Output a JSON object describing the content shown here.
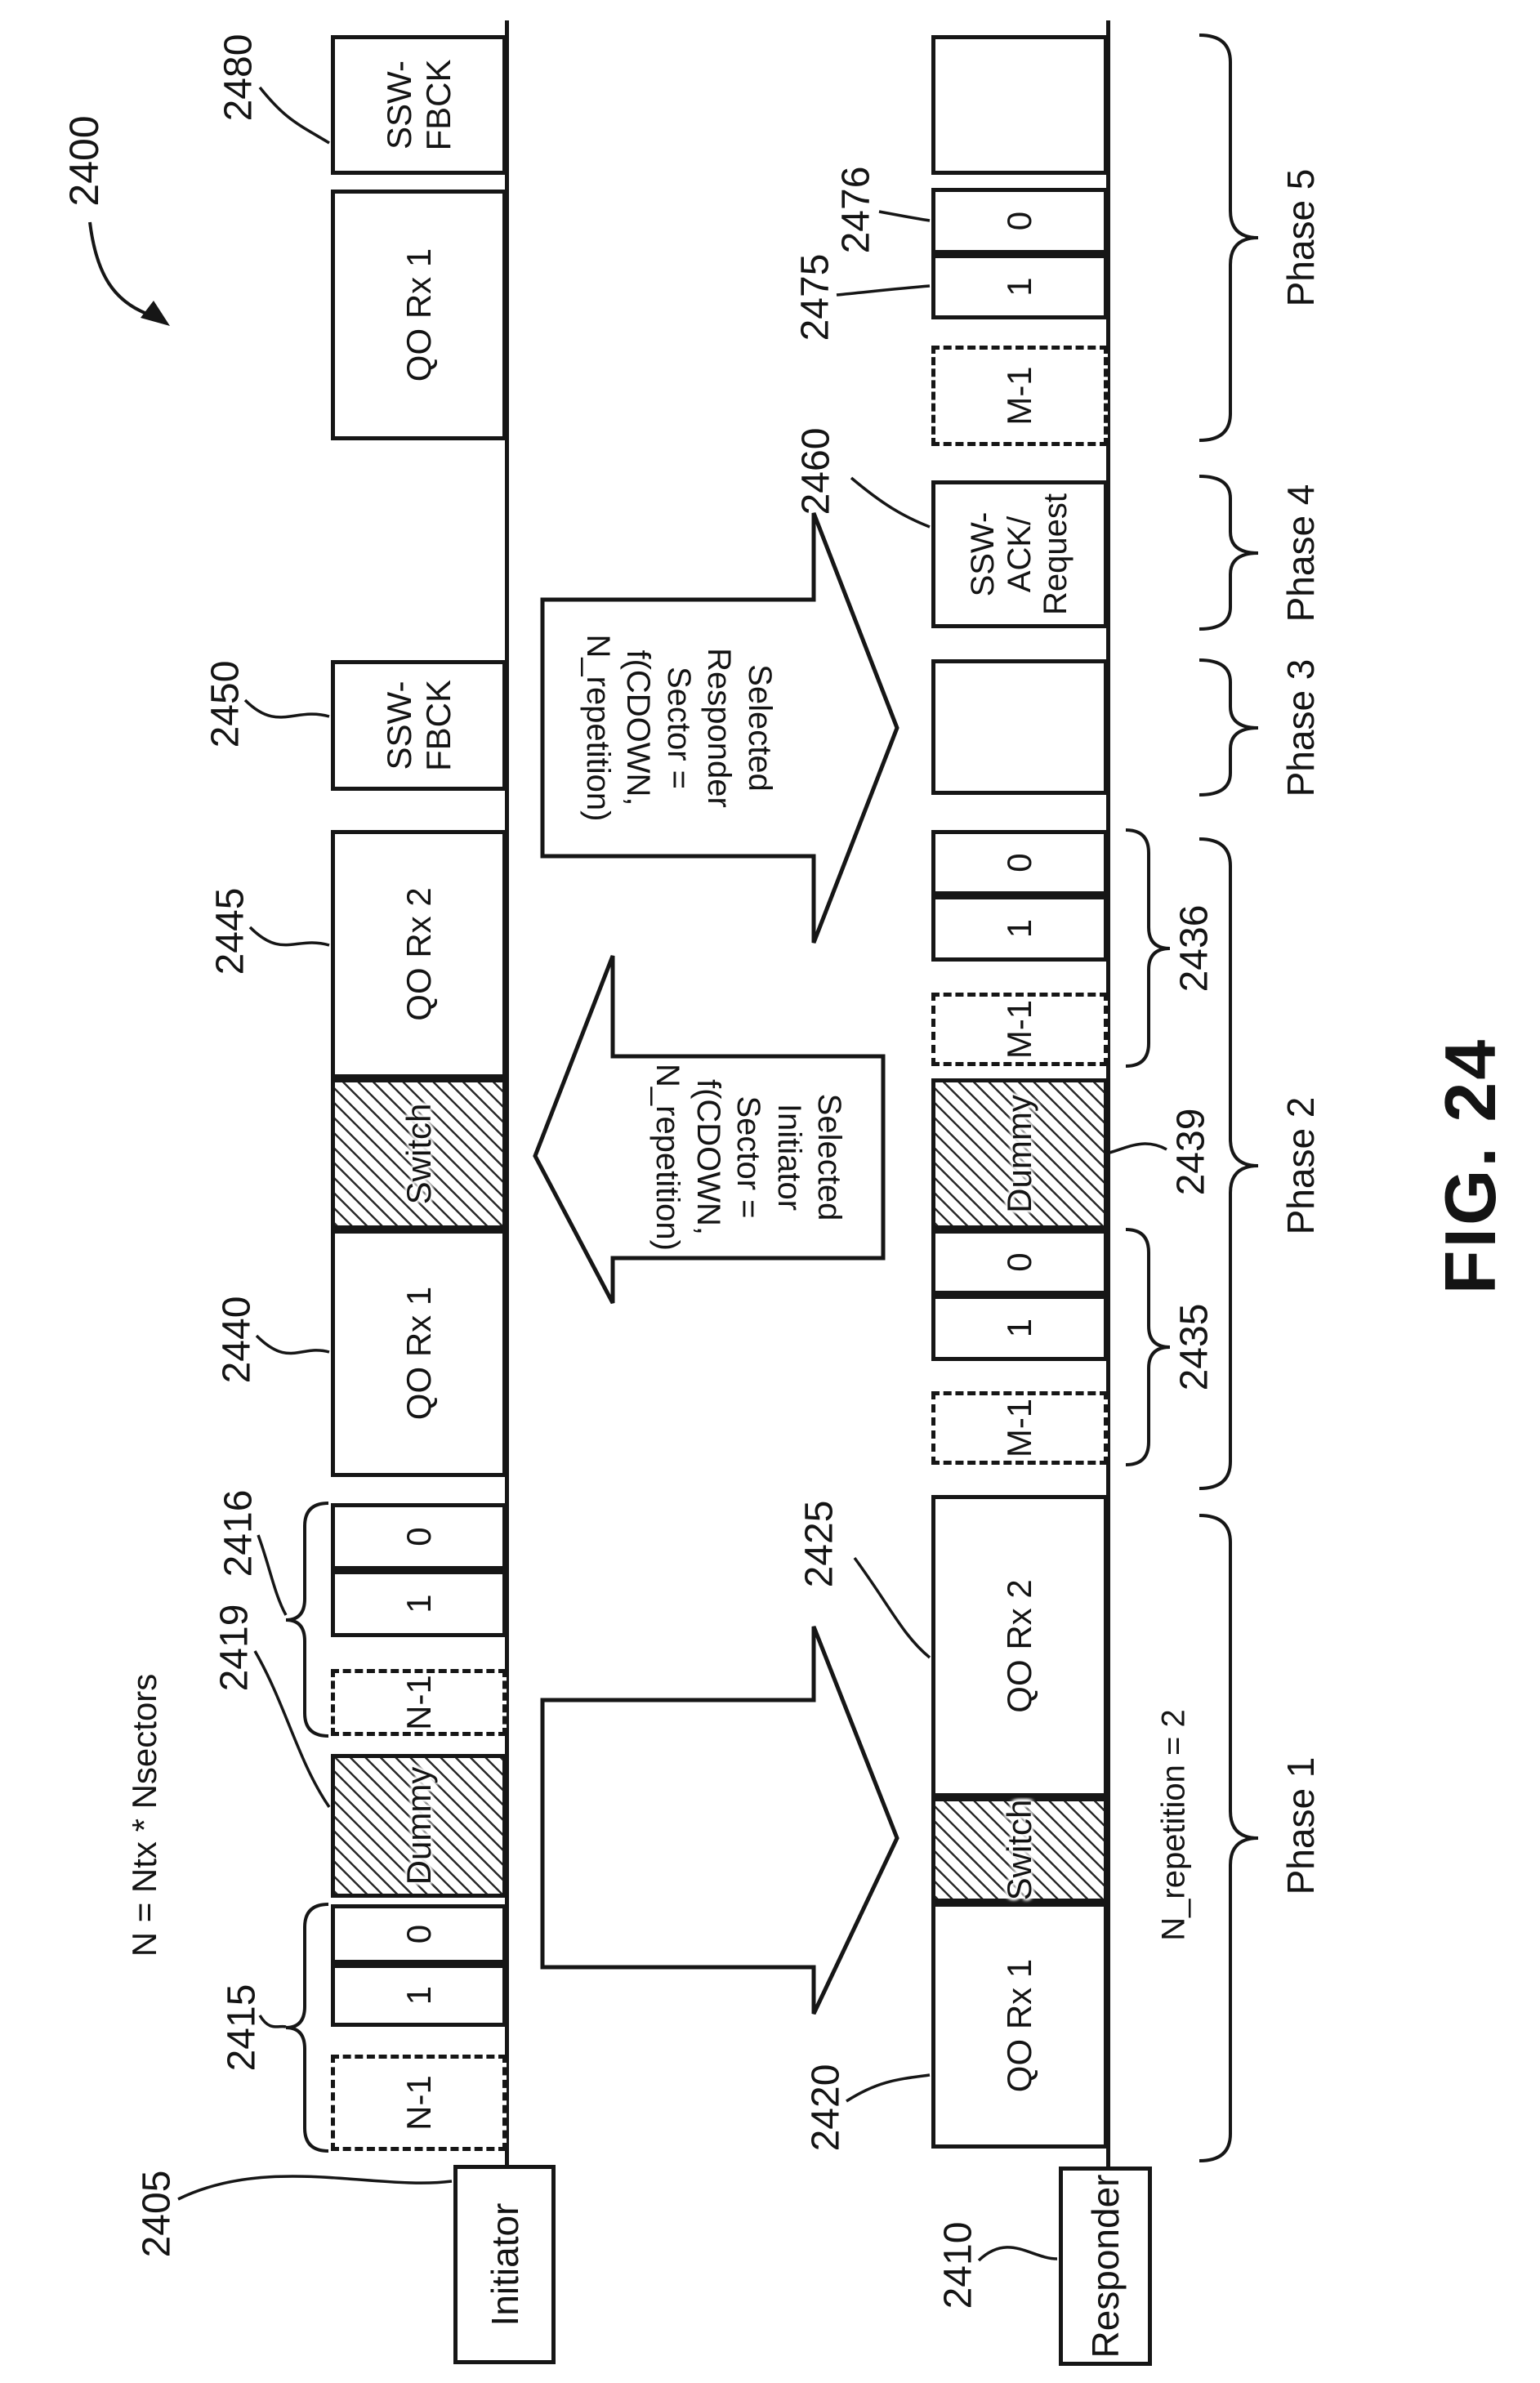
{
  "figure": {
    "label": "FIG. 24"
  },
  "refs": {
    "2400": "2400",
    "2405": "2405",
    "2410": "2410",
    "2415": "2415",
    "2416": "2416",
    "2419": "2419",
    "2420": "2420",
    "2425": "2425",
    "2435": "2435",
    "2436": "2436",
    "2439": "2439",
    "2440": "2440",
    "2445": "2445",
    "2450": "2450",
    "2460": "2460",
    "2475": "2475",
    "2476": "2476",
    "2480": "2480"
  },
  "initiator": {
    "label": "Initiator",
    "blocks": [
      "N-1",
      "1",
      "0",
      "Dummy",
      "N-1",
      "1",
      "0",
      "QO Rx 1",
      "Switch",
      "QO Rx 2",
      "SSW-\nFBCK",
      "QO Rx 1",
      "SSW-\nFBCK"
    ]
  },
  "responder": {
    "label": "Responder",
    "blocks": [
      "QO Rx 1",
      "Switch",
      "QO Rx 2",
      "M-1",
      "1",
      "0",
      "Dummy",
      "M-1",
      "1",
      "0",
      "",
      "SSW-\nACK/\nRequest",
      "M-1",
      "1",
      "0",
      ""
    ]
  },
  "arrows": {
    "responder_sector": {
      "text": "Selected\nResponder\nSector =\nf(CDOWN,\nN_repetition)"
    },
    "initiator_sector": {
      "text": "Selected\nInitiator Sector =\nf(CDOWN,\nN_repetition)"
    }
  },
  "annotations": {
    "n_formula": "N = Ntx * Nsectors",
    "n_repetition": "N_repetition = 2"
  },
  "phases": [
    {
      "label": "Phase 1"
    },
    {
      "label": "Phase 2"
    },
    {
      "label": "Phase 3"
    },
    {
      "label": "Phase 4"
    },
    {
      "label": "Phase 5"
    }
  ]
}
